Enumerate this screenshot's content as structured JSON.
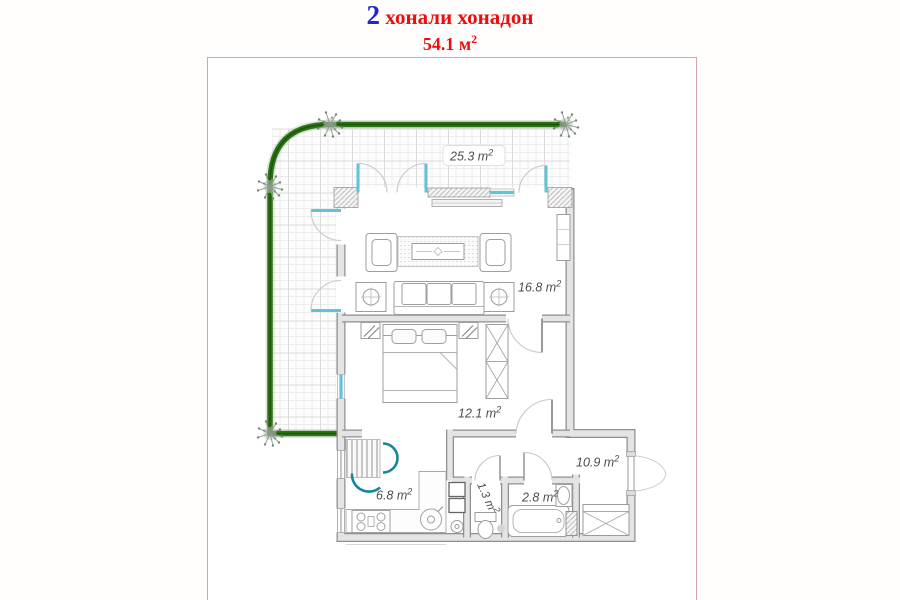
{
  "header": {
    "number": "2",
    "title": " хонали хонадон",
    "area_base": "54.1 м",
    "area_sup": "2"
  },
  "colors": {
    "title_number_blue": "#2222d6",
    "title_red": "#ee0c0c",
    "frame_border": "#d2a4a9",
    "railing_green": "#2c7414",
    "window_cyan": "#62c3d6",
    "kitchen_arc_teal": "#17869c",
    "wall_fill": "#e4e4e4",
    "wall_edge": "#8f8f8f",
    "label_gray": "#4d4d4d"
  },
  "rooms": [
    {
      "name": "terrace",
      "area_base": "25.3 m",
      "area_sup": "2"
    },
    {
      "name": "living-room",
      "area_base": "16.8 m",
      "area_sup": "2"
    },
    {
      "name": "bedroom",
      "area_base": "12.1 m",
      "area_sup": "2"
    },
    {
      "name": "hallway",
      "area_base": "10.9 m",
      "area_sup": "2"
    },
    {
      "name": "kitchen",
      "area_base": "6.8 m",
      "area_sup": "2"
    },
    {
      "name": "wc",
      "area_base": "1.3 m",
      "area_sup": "2"
    },
    {
      "name": "bathroom",
      "area_base": "2.8 m",
      "area_sup": "2"
    }
  ]
}
